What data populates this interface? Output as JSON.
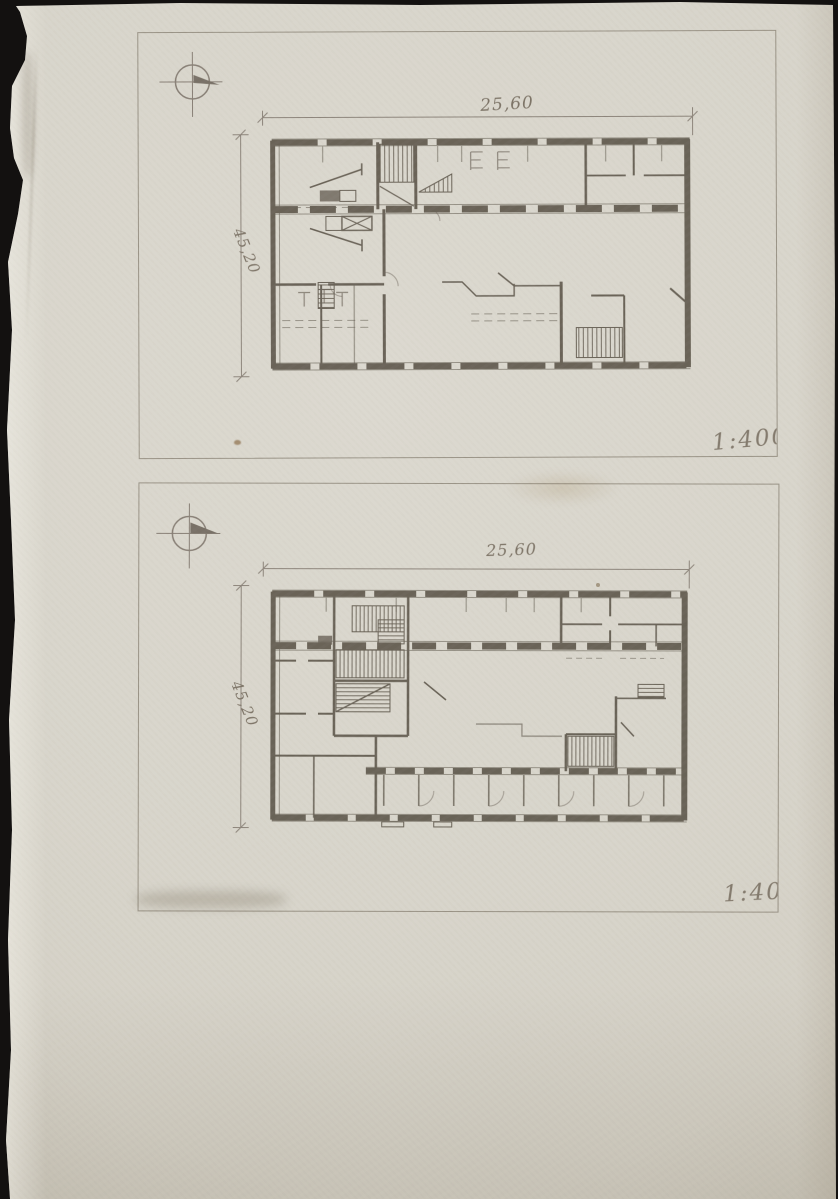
{
  "scan": {
    "paper_color": "#d8d5cb",
    "ink_color": "#4f463a",
    "pencil_color": "#7d7365",
    "background_color": "#131110"
  },
  "panels": [
    {
      "id": "upper-floor",
      "compass_icon": "north-compass-icon",
      "top_dimension": "25,60",
      "side_dimension": "45,20",
      "scale_label": "1:400"
    },
    {
      "id": "lower-floor",
      "compass_icon": "north-compass-icon",
      "top_dimension": "25,60",
      "side_dimension": "45,20",
      "scale_label": "1:400"
    }
  ]
}
